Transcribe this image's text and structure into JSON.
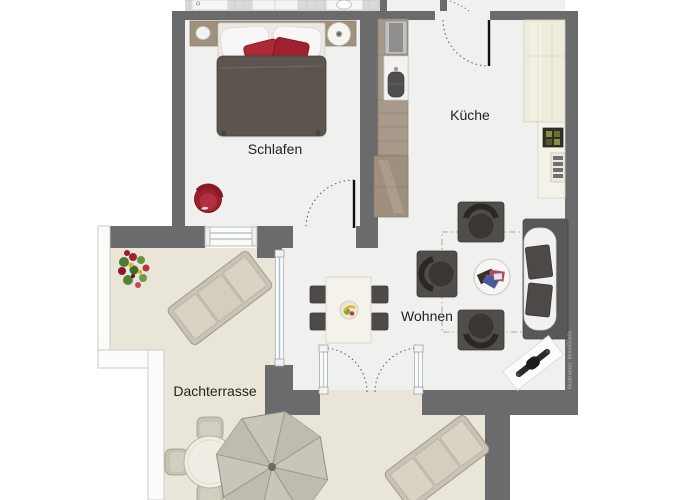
{
  "rooms": [
    {
      "id": "schlafen",
      "label": "Schlafen"
    },
    {
      "id": "kueche",
      "label": "Küche"
    },
    {
      "id": "wohnen",
      "label": "Wohnen"
    },
    {
      "id": "dachterrasse",
      "label": "Dachterrasse"
    }
  ],
  "watermark": "Illustration: ImmoGrafik",
  "colors": {
    "background": "#ffffff",
    "wall": "#6b6b6d",
    "interior_floor": "#f0f0ee",
    "terrace_floor": "#e9e5d8",
    "accent_red": "#a32230",
    "furniture_dark": "#4e4a48",
    "kitchen_wood": "#a89a8a",
    "cabinet_cream": "#efebdd"
  },
  "furniture": {
    "schlafen": [
      "double-bed",
      "headboard",
      "nightstand-left",
      "nightstand-right",
      "table-lamp",
      "red-armchair"
    ],
    "kueche": [
      "kitchen-counter",
      "cooktop",
      "sink",
      "lower-cabinet",
      "tall-cabinet",
      "counter-right",
      "small-appliance",
      "vent-unit"
    ],
    "wohnen": [
      "dining-table",
      "dining-chair",
      "fruit-bowl",
      "armchair",
      "coffee-table",
      "magazines",
      "sofa",
      "deco-mat"
    ],
    "dachterrasse": [
      "flower-pot",
      "sun-lounger-upper",
      "sun-lounger-lower",
      "round-table",
      "terrace-chair",
      "parasol"
    ]
  },
  "openings": [
    "entry-door",
    "bedroom-door",
    "french-doors",
    "terrace-window",
    "glass-front",
    "terrace-railing"
  ]
}
